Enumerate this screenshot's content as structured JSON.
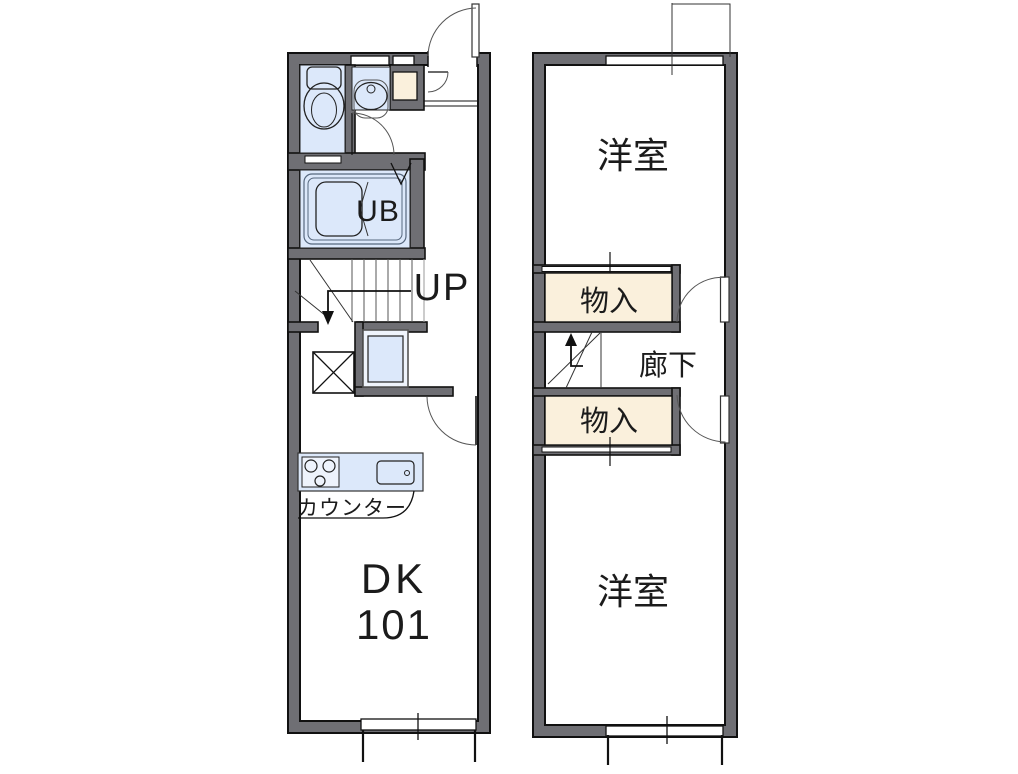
{
  "floor_plan": {
    "colors": {
      "wall": "#6f6f74",
      "wall_outline": "#111111",
      "room_fill_blue": "#dce8fa",
      "closet_fill_cream": "#faf0dc",
      "arc_line": "#555555"
    },
    "first_floor": {
      "unit_bath_label": "UB",
      "stairs_label": "UP",
      "room_name": "DK",
      "room_number": "101",
      "counter_label": "カウンター"
    },
    "second_floor": {
      "room_top_label": "洋室",
      "closet_top_label": "物入",
      "hall_label": "廊下",
      "closet_bottom_label": "物入",
      "room_bottom_label": "洋室"
    }
  }
}
